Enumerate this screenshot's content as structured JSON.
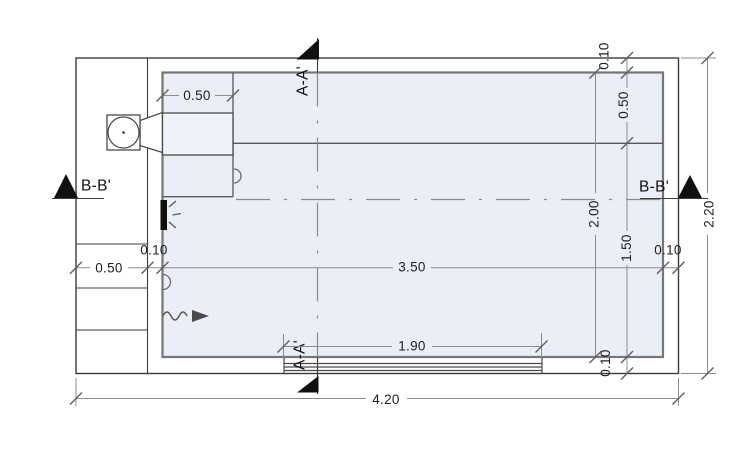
{
  "plan": {
    "description": "Rectangular tank plan view with section cuts and dimension chains",
    "section_labels": {
      "aa_top": "A-A'",
      "aa_bottom": "A-A'",
      "bb_left": "B-B'",
      "bb_right": "B-B'"
    },
    "dimensions": {
      "inlet_box_width": "0.50",
      "left_chamber_width": "0.50",
      "left_wall_thickness": "0.10",
      "interior_length": "3.50",
      "right_wall_thickness": "0.10",
      "outlet_strip_length": "1.90",
      "overall_length": "4.20",
      "top_wall_thickness": "0.10",
      "top_zone_height": "0.50",
      "interior_height": "2.00",
      "lower_zone_height": "1.50",
      "bottom_wall_thickness": "0.10",
      "overall_height": "2.20"
    },
    "colors": {
      "water_fill": "#e9eef7",
      "wall_line": "#767676",
      "outline": "#3c3c3c",
      "dimension_line": "#8c8c8c",
      "text": "#1f1f1f",
      "marker_fill": "#101010"
    }
  }
}
